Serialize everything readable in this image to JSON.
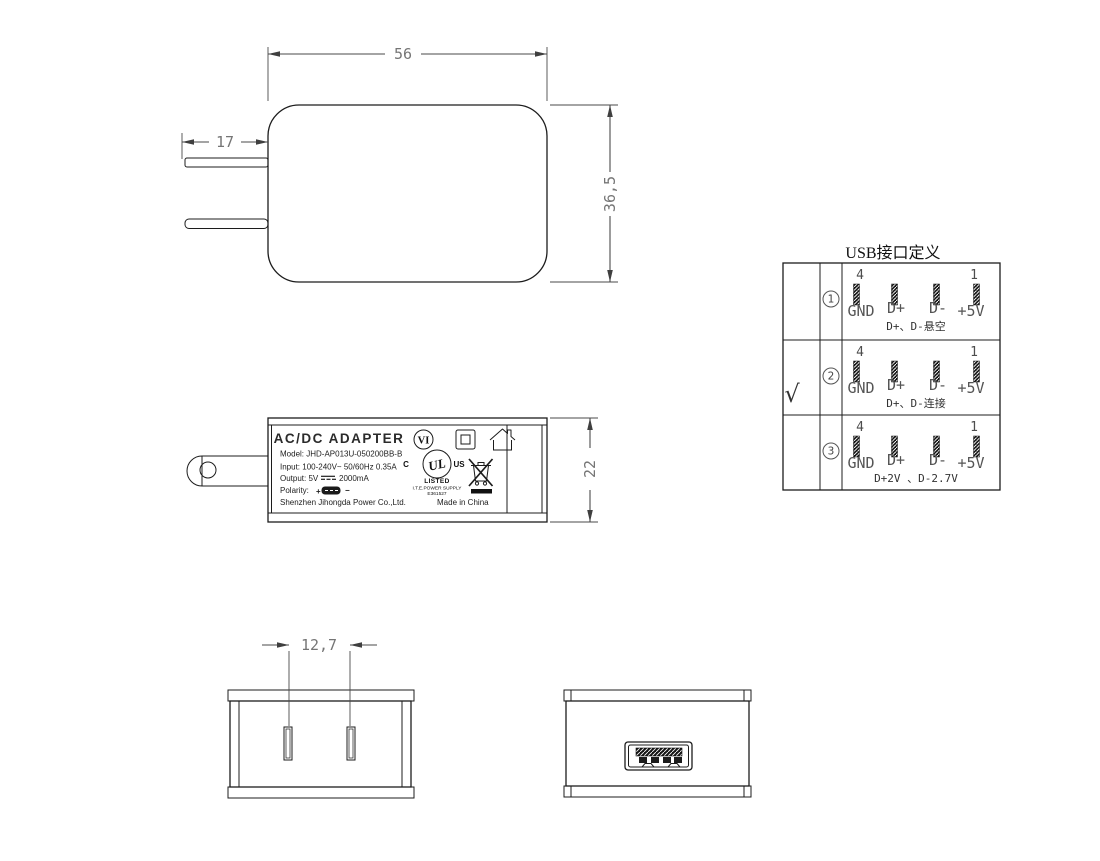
{
  "front_view": {
    "width_mm": "56",
    "height_mm": "36,5",
    "prong_length_mm": "17"
  },
  "side_view": {
    "height_mm": "22"
  },
  "label": {
    "title": "AC/DC  ADAPTER",
    "model": "Model: JHD-AP013U-050200BB-B",
    "input": "Input: 100-240V~  50/60Hz  0.35A",
    "output_prefix": "Output: 5V",
    "output_suffix": "2000mA",
    "polarity_label": "Polarity:",
    "polarity_plus": "+",
    "polarity_minus": "−",
    "manufacturer": "Shenzhen Jihongda Power Co.,Ltd.",
    "made_in": "Made in China",
    "efficiency_mark": "VI",
    "ul_c": "C",
    "ul_logo": "UL",
    "ul_us": "US",
    "ul_listed": "LISTED",
    "ul_type": "I.T.E.POWER SUPPLY",
    "ul_file": "E361527"
  },
  "bottom_view": {
    "prong_spacing_mm": "12,7"
  },
  "usb_table": {
    "title": "USB接口定义",
    "rows": [
      {
        "check": "",
        "num": "1",
        "pin_start": "4",
        "pin_end": "1",
        "pins": [
          "GND",
          "D+",
          "D-",
          "+5V"
        ],
        "note": "D+、D-悬空"
      },
      {
        "check": "√",
        "num": "2",
        "pin_start": "4",
        "pin_end": "1",
        "pins": [
          "GND",
          "D+",
          "D-",
          "+5V"
        ],
        "note": "D+、D-连接"
      },
      {
        "check": "",
        "num": "3",
        "pin_start": "4",
        "pin_end": "1",
        "pins": [
          "GND",
          "D+",
          "D-",
          "+5V"
        ],
        "note": "D+2V 、D-2.7V"
      }
    ]
  }
}
